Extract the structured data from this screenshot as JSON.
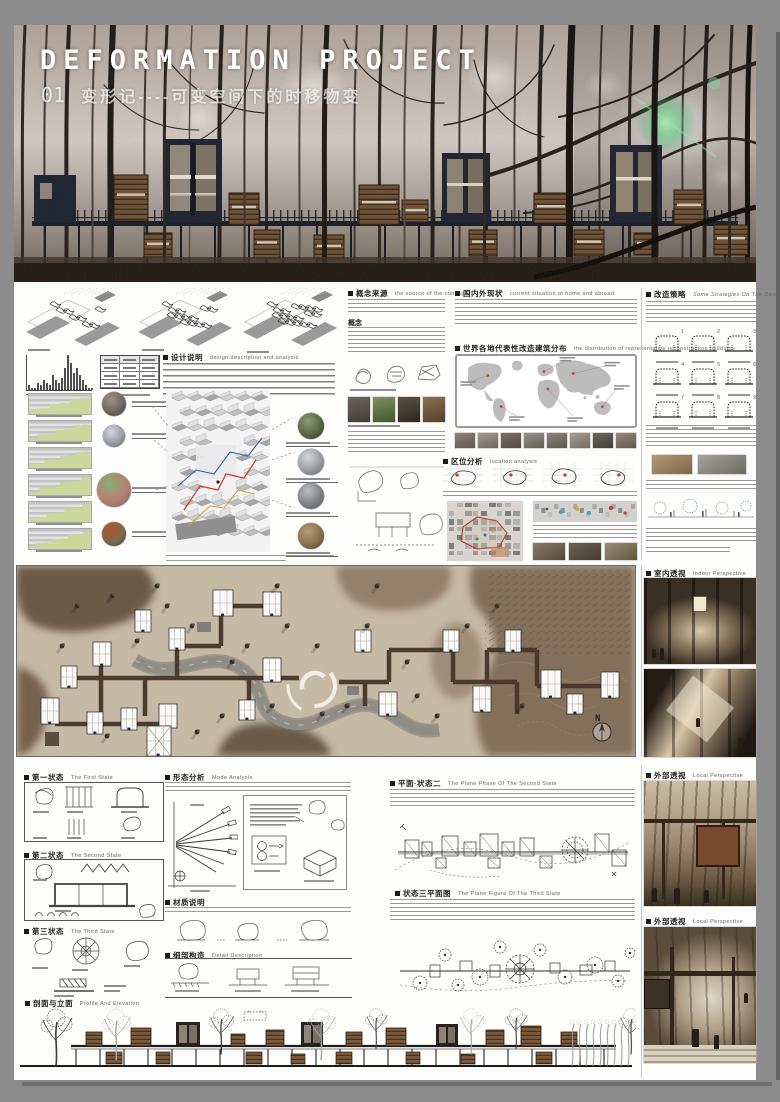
{
  "window": {
    "background": "#8c8c8c",
    "accent_green": "#ccd79b",
    "accent_red": "#c0392b",
    "accent_blue": "#3567b0",
    "accent_yellow": "#d9a62e"
  },
  "hero": {
    "title": "DEFORMATION PROJECT",
    "index": "01",
    "subtitle": "变形记----可变空间下的时移物变"
  },
  "chart_data": {
    "type": "bar",
    "values": [
      2,
      1,
      1,
      3,
      2,
      4,
      3,
      2,
      6,
      4,
      3,
      5,
      9,
      14,
      11,
      7,
      9,
      6,
      4,
      2,
      1,
      1
    ],
    "title": "",
    "xlabel": "",
    "ylabel": "",
    "ylim": [
      0,
      14
    ]
  },
  "analysis": {
    "headings": {
      "design": {
        "cn": "设计说明",
        "en": "design description and analysis"
      },
      "concept": {
        "cn": "概念来源",
        "en": "the source of the concept"
      },
      "concept_sub": "概念",
      "status": {
        "cn": "国内外现状",
        "en": "current situation at home and abroad"
      },
      "world_map": {
        "cn": "世界各地代表性改造建筑分布",
        "en": "the distribution of representative reconstruction buildings"
      },
      "location": {
        "cn": "区位分析",
        "en": "location analysis"
      },
      "strategy": {
        "cn": "改造策略",
        "en": "Some Strategies On The Design"
      }
    },
    "strategy_numbers": [
      "1",
      "2",
      "3",
      "4",
      "5",
      "6",
      "7",
      "8",
      "9"
    ],
    "left_circle_photos": [
      {
        "name": "street-shop-photo",
        "d": 24,
        "tones": [
          "#9b948b",
          "#6f675e",
          "#3f3a33"
        ]
      },
      {
        "name": "white-building-photo",
        "d": 22,
        "tones": [
          "#d3d6da",
          "#9a9da1",
          "#64605a"
        ]
      },
      {
        "name": "basketball-court-photo",
        "d": 34,
        "tones": [
          "#86b073",
          "#b97e72",
          "#6d6a5f"
        ]
      },
      {
        "name": "temple-photo",
        "d": 24,
        "tones": [
          "#b0562f",
          "#7c6a4e",
          "#473d32"
        ]
      }
    ],
    "right_circle_photos": [
      {
        "name": "green-towers-photo",
        "d": 26,
        "tones": [
          "#8f9a7a",
          "#57673f",
          "#2f3a28"
        ]
      },
      {
        "name": "white-apartment-photo",
        "d": 26,
        "tones": [
          "#d5d8db",
          "#989ca1",
          "#6e6a62"
        ]
      },
      {
        "name": "gray-building-photo",
        "d": 26,
        "tones": [
          "#bbbdbf",
          "#7e8184",
          "#55575a"
        ]
      },
      {
        "name": "pagoda-photo",
        "d": 26,
        "tones": [
          "#b59a76",
          "#8a6f4a",
          "#4d3f2d"
        ]
      }
    ],
    "concept_case_photos": [
      {
        "name": "dark-tower-photo",
        "tones": [
          "#6a645d",
          "#423d37"
        ]
      },
      {
        "name": "green-tower-photo",
        "tones": [
          "#7a9460",
          "#44552f"
        ]
      },
      {
        "name": "interior-photo",
        "tones": [
          "#5b4f41",
          "#2f2820"
        ]
      },
      {
        "name": "cave-house-photo",
        "tones": [
          "#8a6f50",
          "#55412d"
        ]
      }
    ],
    "world_map_strip_photos": [
      {
        "tones": [
          "#8d857b",
          "#5c564d"
        ]
      },
      {
        "tones": [
          "#a39b91",
          "#6f675f"
        ]
      },
      {
        "tones": [
          "#7b7268",
          "#4e4840"
        ]
      },
      {
        "tones": [
          "#9a938b",
          "#655e55"
        ]
      },
      {
        "tones": [
          "#8f867c",
          "#5d564e"
        ]
      },
      {
        "tones": [
          "#a8a096",
          "#736b61"
        ]
      },
      {
        "tones": [
          "#6f675f",
          "#433d36"
        ]
      },
      {
        "tones": [
          "#948b80",
          "#5f584f"
        ]
      }
    ],
    "location_photos": [
      {
        "tones": [
          "#8a7a66",
          "#56493a"
        ]
      },
      {
        "tones": [
          "#6e6152",
          "#453b2f"
        ]
      },
      {
        "tones": [
          "#9b8b74",
          "#645741"
        ]
      }
    ],
    "strategy_photos": [
      {
        "name": "timber-slats-photo",
        "tones": [
          "#b39a74",
          "#7c6747"
        ]
      },
      {
        "name": "rubble-site-photo",
        "tones": [
          "#a5a09a",
          "#6d6a64"
        ]
      }
    ]
  },
  "masterplan": {
    "north_label": "N"
  },
  "perspectives": {
    "indoor": {
      "cn": "室内透视",
      "en": "Indoor Perspective"
    },
    "outdoor1": {
      "cn": "外部透视",
      "en": "Local Perspective"
    },
    "outdoor2": {
      "cn": "外部透视",
      "en": "Local Perspective"
    }
  },
  "states": {
    "first": {
      "cn": "第一状态",
      "en": "The First State"
    },
    "second": {
      "cn": "第二状态",
      "en": "The Second State"
    },
    "third": {
      "cn": "第三状态",
      "en": "The Third State"
    },
    "mode": {
      "cn": "形态分析",
      "en": "Mode Analysis"
    },
    "material": {
      "cn": "材质说明",
      "en": ""
    },
    "detail": {
      "cn": "细部构造",
      "en": "Detail Description"
    },
    "plan2": {
      "cn": "平面·状态二",
      "en": "The Plane Phase Of The Second State"
    },
    "plan3": {
      "cn": "状态三平面图",
      "en": "The Plane Figure Of The Third State"
    },
    "elevation": {
      "cn": "剖面与立面",
      "en": "Profile And Elevation"
    }
  }
}
